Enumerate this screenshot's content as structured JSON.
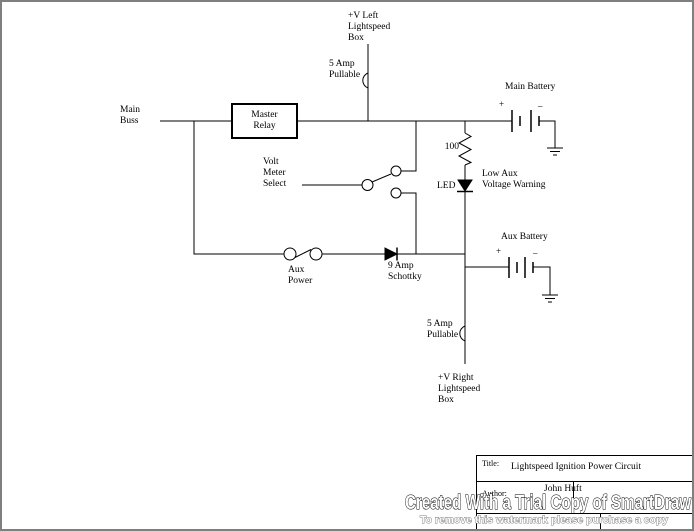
{
  "diagram": {
    "labels": {
      "v_left": "+V Left\nLightspeed\nBox",
      "fuse_top": "5 Amp\nPullable",
      "main_buss": "Main\nBuss",
      "master_relay": "Master\nRelay",
      "main_battery": "Main Battery",
      "main_battery_plus": "+",
      "main_battery_minus": "–",
      "resistor_value": "100",
      "led": "LED",
      "low_aux_warning": "Low Aux\nVoltage Warning",
      "volt_meter_select": "Volt\nMeter\nSelect",
      "aux_power": "Aux\nPower",
      "schottky": "9 Amp\nSchottky",
      "aux_battery": "Aux Battery",
      "aux_battery_plus": "+",
      "aux_battery_minus": "–",
      "fuse_bottom": "5 Amp\nPullable",
      "v_right": "+V Right\nLightspeed\nBox"
    },
    "line_color": "#000000",
    "page_border_color": "#7f7f7f"
  },
  "title_block": {
    "title_label": "Title:",
    "title_value": "Lightspeed Ignition Power Circuit",
    "author_label": "Author:",
    "author_value": "John Huft"
  },
  "watermark": {
    "line1": "Created With a Trial Copy of SmartDraw",
    "line2": "To remove this watermark please purchase a copy"
  }
}
